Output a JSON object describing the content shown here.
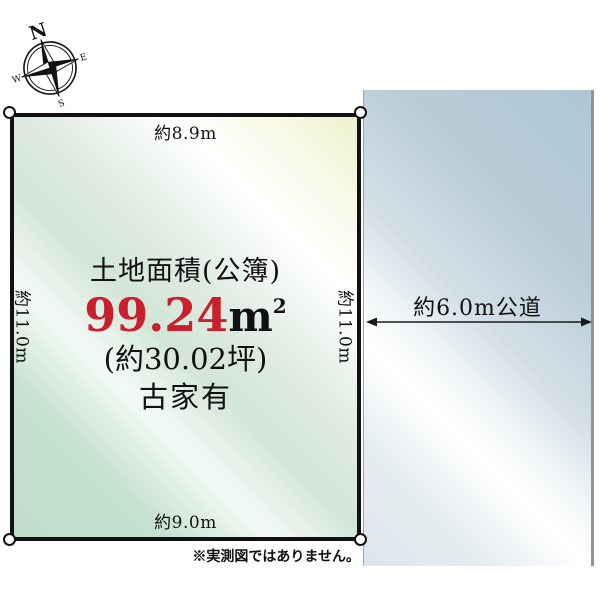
{
  "compass": {
    "north": "N",
    "east": "E",
    "south": "S",
    "west": "W"
  },
  "plot": {
    "top_dim": "約8.9m",
    "left_dim": "約11.0m",
    "right_dim": "約11.0m",
    "bottom_dim": "約9.0m",
    "title": "土地面積(公簿)",
    "area_value": "99.24",
    "area_unit": "m",
    "area_sup": "2",
    "tsubo": "(約30.02坪)",
    "building_note": "古家有"
  },
  "road": {
    "label": "約6.0m公道",
    "width_note": "6.0m"
  },
  "footnote": "※実測図ではありません。",
  "colors": {
    "area_value_red": "#c8202c",
    "outline_black": "#111111",
    "plot_fill_top_right": "#edf1cc",
    "plot_fill_bottom_left": "#bedeca",
    "road_fill_dark": "#afc6d4",
    "road_fill_light": "#ffffff",
    "road_border": "#8d959b"
  }
}
